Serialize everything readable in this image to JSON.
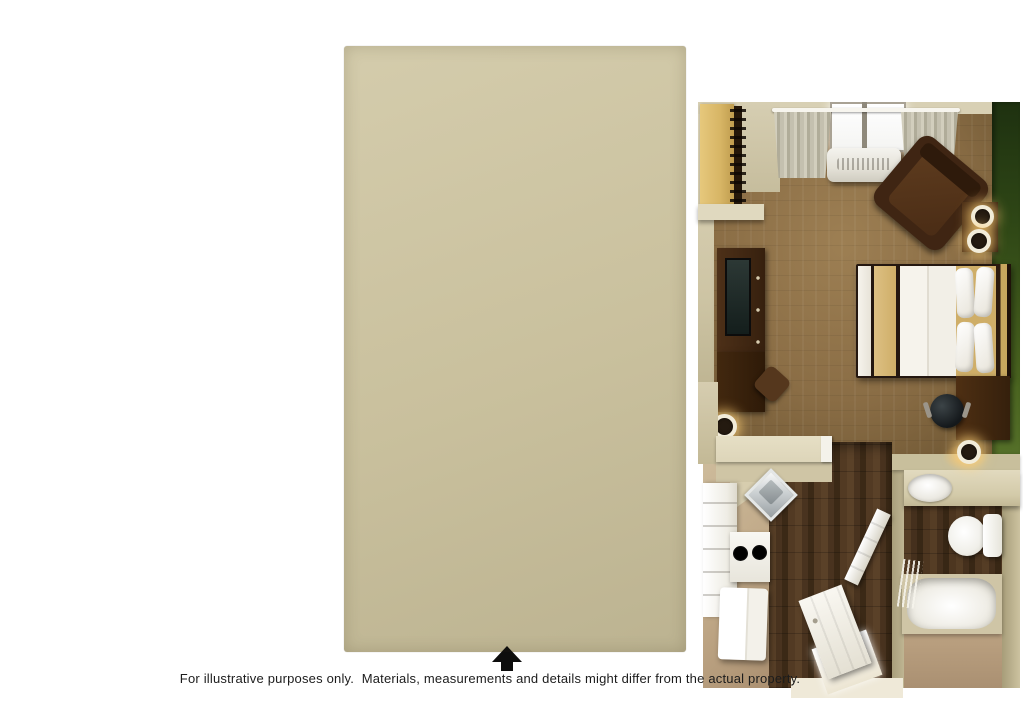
{
  "caption": {
    "text": "For illustrative purposes only.  Materials, measurements and details might differ from the actual property."
  },
  "compass": {
    "icon": "north-arrow-icon",
    "direction": "up"
  },
  "palette": {
    "background": "#ffffff",
    "outer_wall": "#c9c09d",
    "interior_wall": "#d5cdb1",
    "accent_wall_green": "#3d5519",
    "carpet": "#8a6d45",
    "hall_wood_floor": "#4b351f",
    "kitchen_bath_floor": "#bfa786",
    "counter": "#ddd5b9",
    "cabinets_white": "#f2f0e9",
    "dark_wood_furniture": "#40270f",
    "bed_linens_white": "#f4f1ea",
    "bed_accent_tan": "#d6b877",
    "fixtures_white": "#f5f4ef",
    "caption_text": "#1c1c1c"
  }
}
